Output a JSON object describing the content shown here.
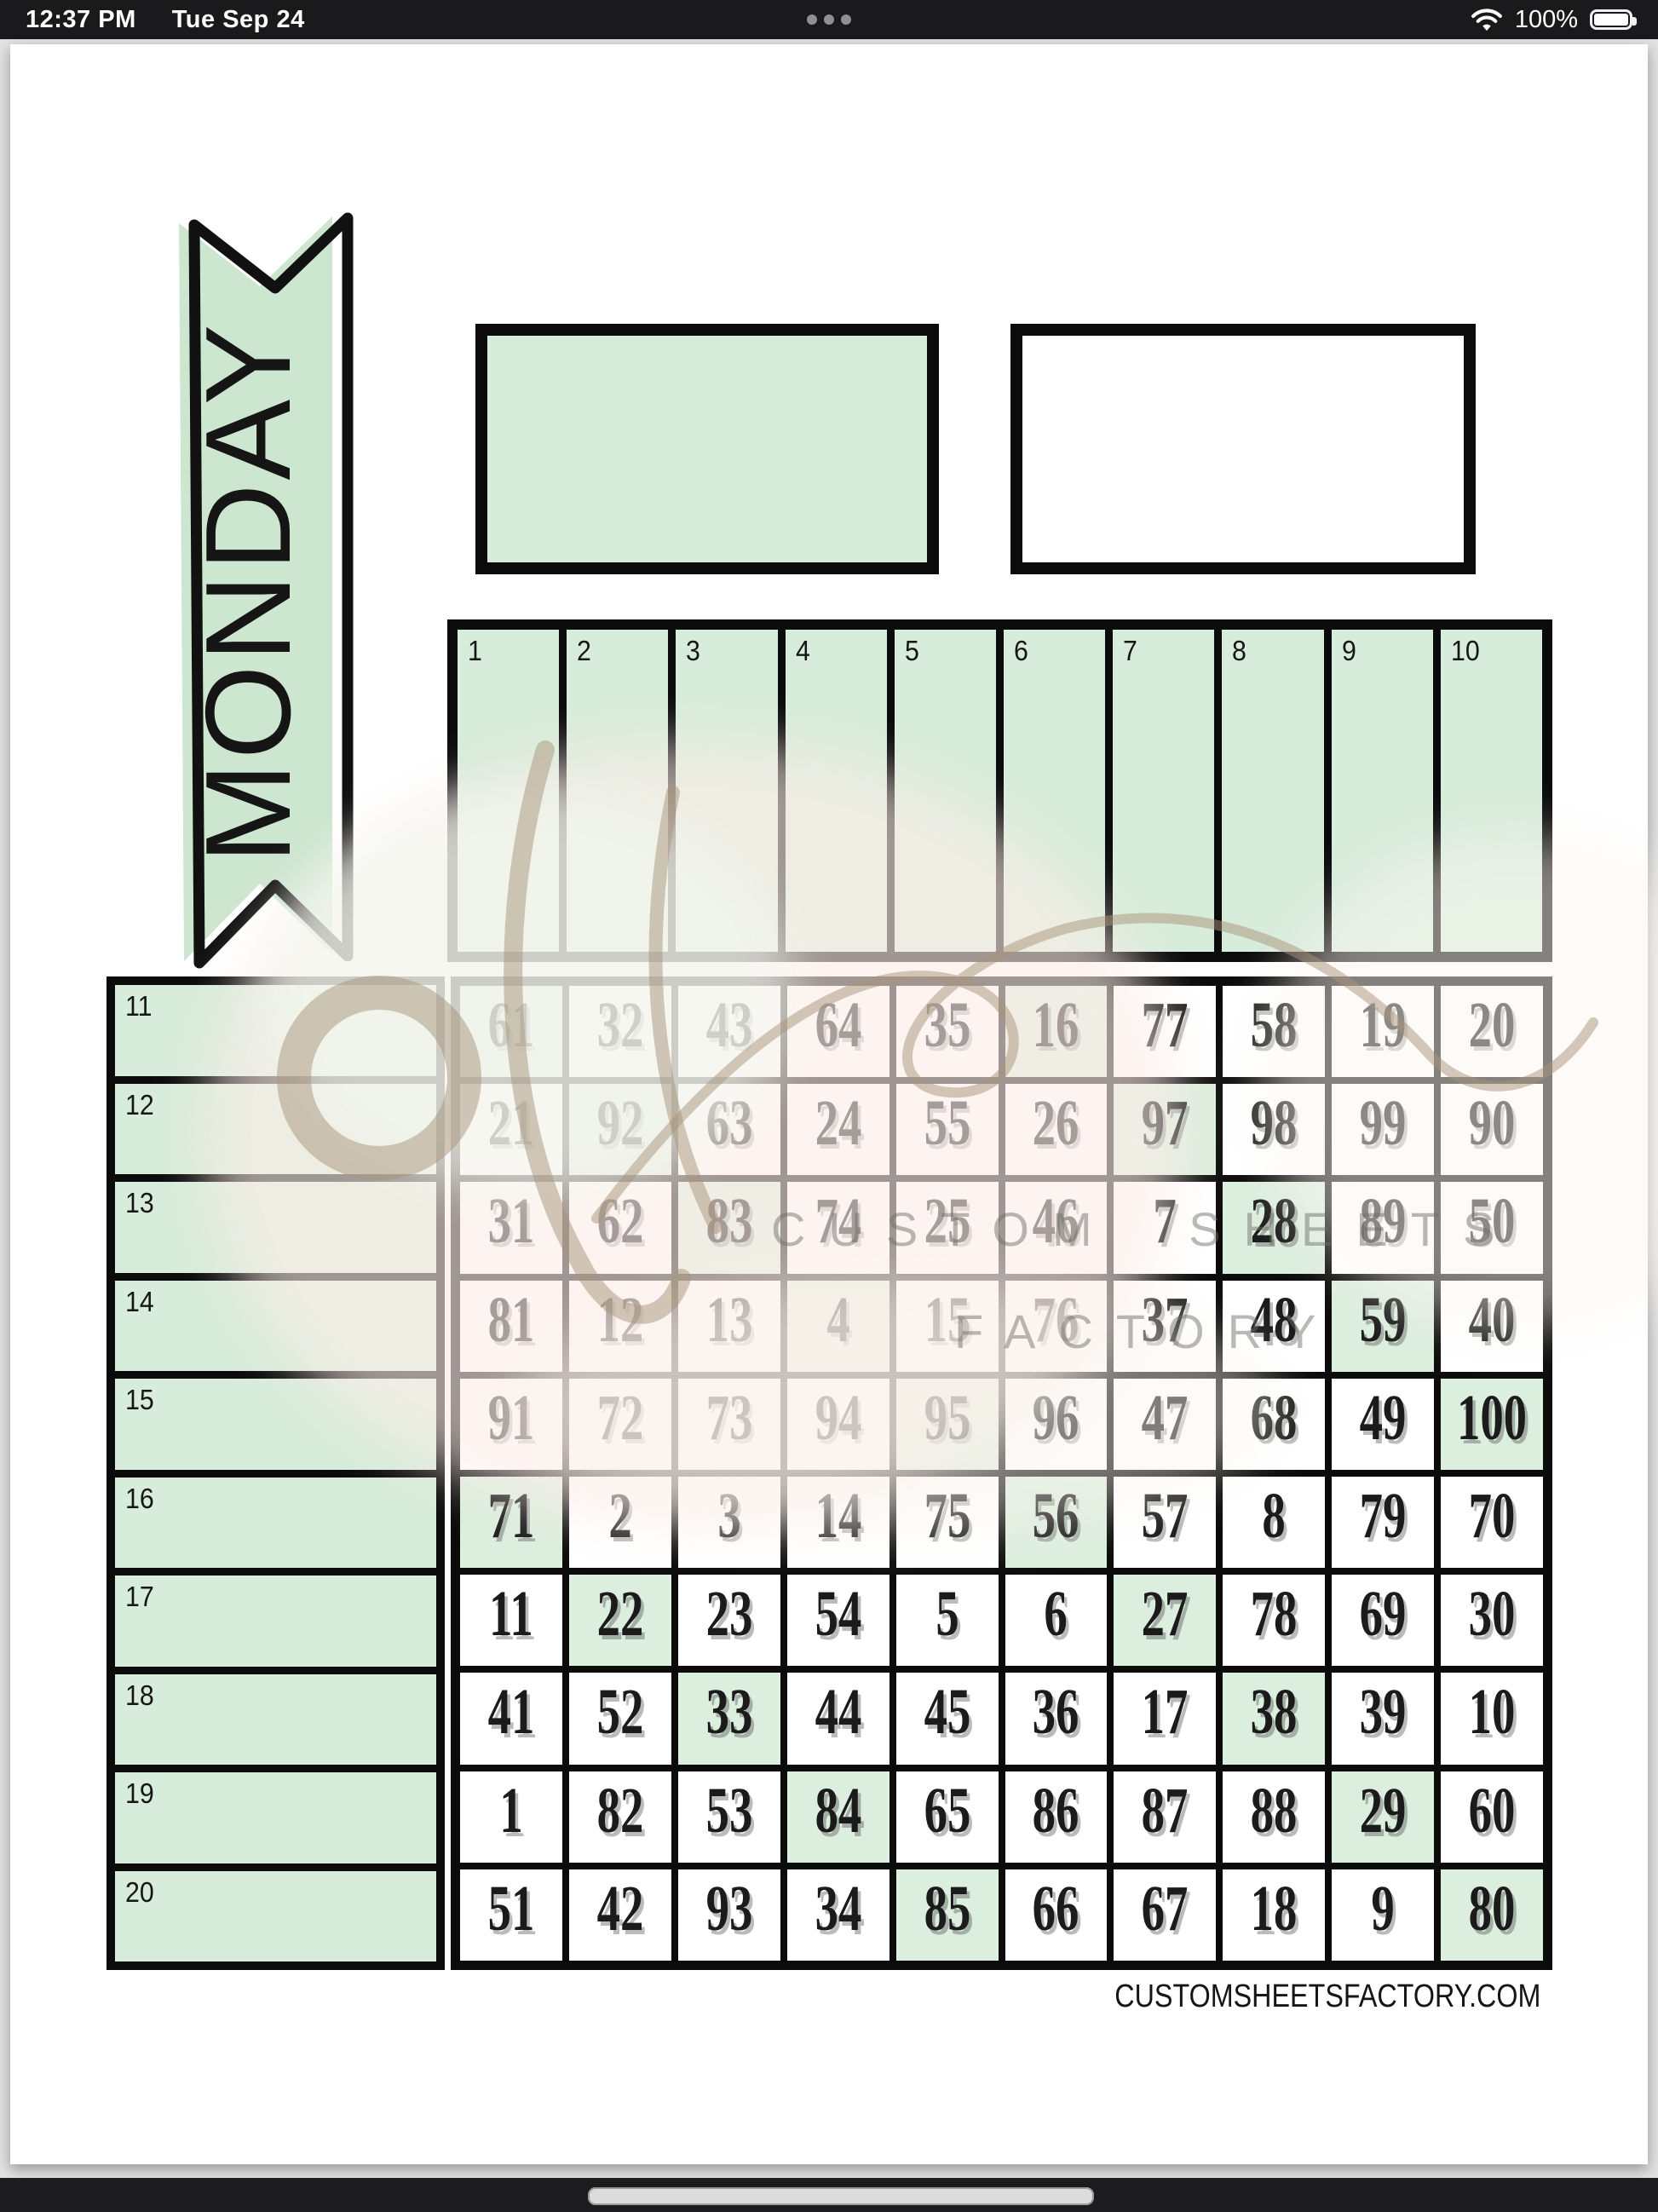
{
  "status_bar": {
    "time": "12:37 PM",
    "date": "Tue Sep 24",
    "battery_percent": "100%"
  },
  "banner": {
    "label": "MONDAY"
  },
  "top_columns": [
    "1",
    "2",
    "3",
    "4",
    "5",
    "6",
    "7",
    "8",
    "9",
    "10"
  ],
  "left_rows": [
    "11",
    "12",
    "13",
    "14",
    "15",
    "16",
    "17",
    "18",
    "19",
    "20"
  ],
  "grid": {
    "rows": [
      [
        61,
        32,
        43,
        64,
        35,
        16,
        77,
        58,
        19,
        20
      ],
      [
        21,
        92,
        63,
        24,
        55,
        26,
        97,
        98,
        99,
        90
      ],
      [
        31,
        62,
        83,
        74,
        25,
        46,
        7,
        28,
        89,
        50
      ],
      [
        81,
        12,
        13,
        4,
        15,
        76,
        37,
        48,
        59,
        40
      ],
      [
        91,
        72,
        73,
        94,
        95,
        96,
        47,
        68,
        49,
        100
      ],
      [
        71,
        2,
        3,
        14,
        75,
        56,
        57,
        8,
        79,
        70
      ],
      [
        11,
        22,
        23,
        54,
        5,
        6,
        27,
        78,
        69,
        30
      ],
      [
        41,
        52,
        33,
        44,
        45,
        36,
        17,
        38,
        39,
        10
      ],
      [
        1,
        82,
        53,
        84,
        65,
        86,
        87,
        88,
        29,
        60
      ],
      [
        51,
        42,
        93,
        34,
        85,
        66,
        67,
        18,
        9,
        80
      ]
    ],
    "green_values": [
      61,
      16,
      92,
      97,
      83,
      28,
      4,
      59,
      95,
      100,
      71,
      56,
      22,
      27,
      33,
      38,
      84,
      29,
      85,
      80
    ]
  },
  "watermark": {
    "line1": "CUSTOM SHEETS",
    "line2": "FACTORY"
  },
  "footer": {
    "website": "CUSTOMSHEETSFACTORY.COM"
  },
  "colors": {
    "mint": "#d8ecdb",
    "mint_cell": "#dceede",
    "ribbon_mint": "#cde6d0",
    "border": "#0b0b0b",
    "status_bg": "#1a1a1c",
    "watermark_tan": "#a79377"
  }
}
